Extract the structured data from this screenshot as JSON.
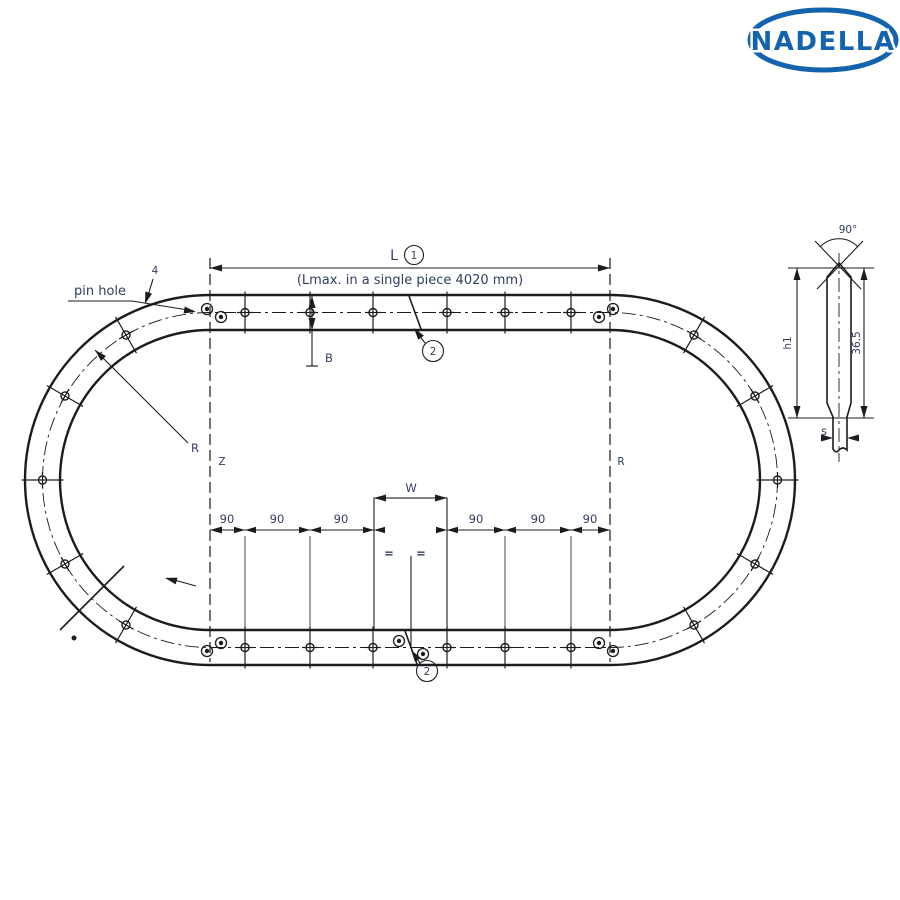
{
  "colors": {
    "line": "#1c1c1e",
    "ink": "#2f3d5f",
    "logo": "#1463ae",
    "bg": "#ffffff"
  },
  "logo": {
    "brand": "NADELLA"
  },
  "plan": {
    "pin_hole_label": "pin hole",
    "pin_hole_dia": "4",
    "length_label": "L",
    "length_ref": "1",
    "length_note": "(Lmax. in a single piece 4020 mm)",
    "rail_width_label": "B",
    "joint_ref": "2",
    "joint_ref_bottom": "2",
    "tangent_left_label": "Z",
    "tangent_right_label": "R",
    "radius_label": "R",
    "hole_spacing": [
      "90",
      "90",
      "90",
      "90",
      "90",
      "90"
    ],
    "joint_gap_label": "W",
    "equal_mark": "="
  },
  "section": {
    "groove_angle": "90°",
    "height_label": "h1",
    "width_label": "36.5",
    "thickness_label": "s"
  }
}
